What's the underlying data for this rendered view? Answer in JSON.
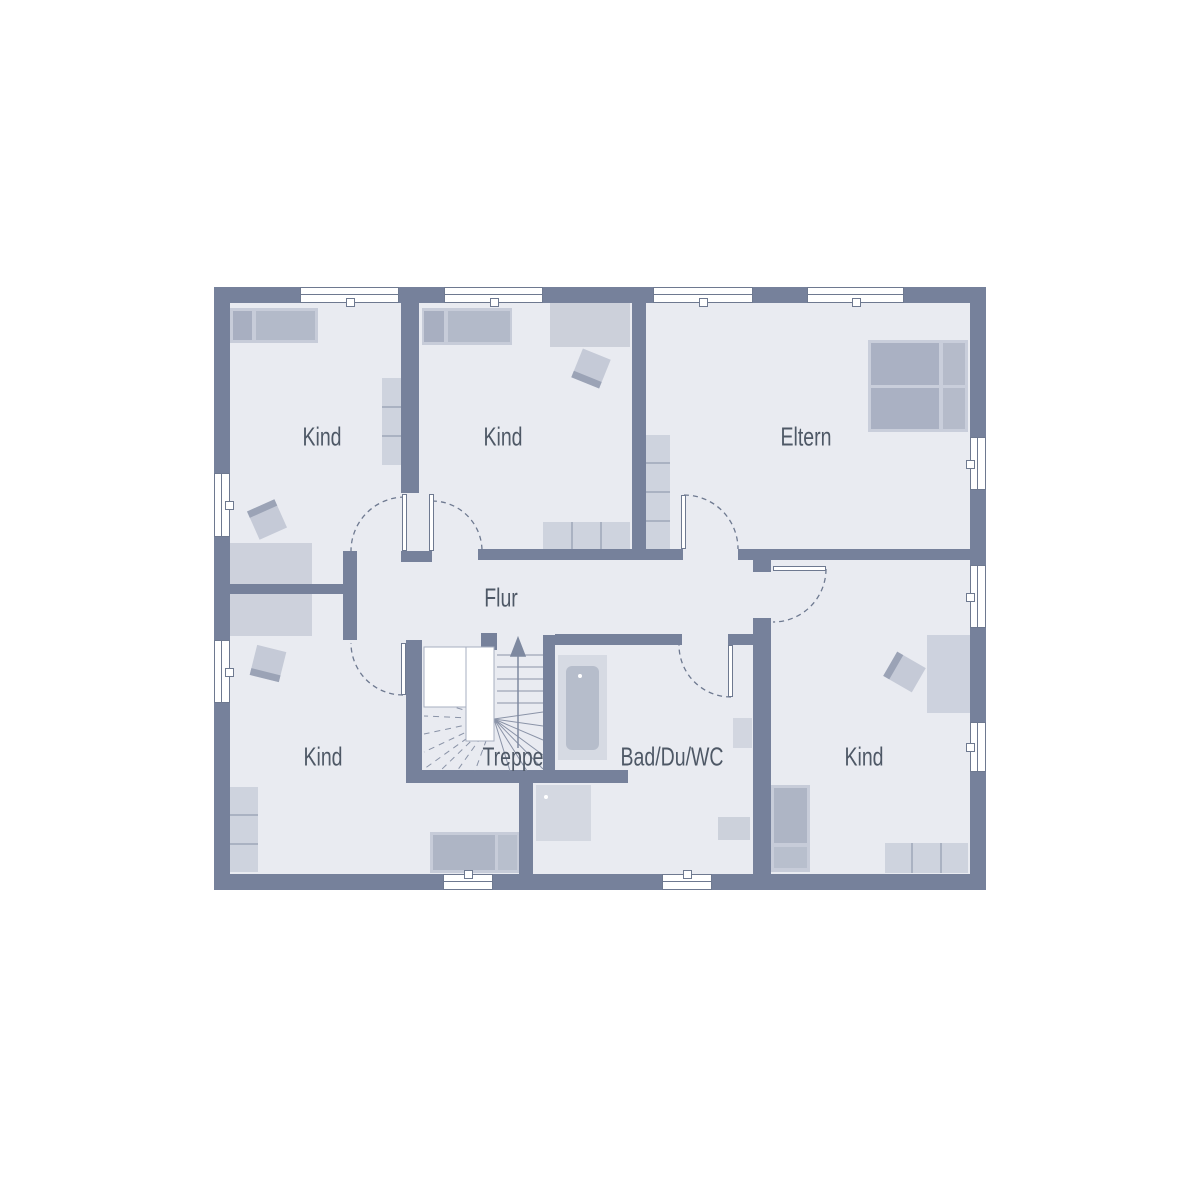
{
  "floorplan": {
    "rooms": [
      {
        "id": "kind-top-left",
        "label": "Kind"
      },
      {
        "id": "kind-top-middle",
        "label": "Kind"
      },
      {
        "id": "eltern",
        "label": "Eltern"
      },
      {
        "id": "flur",
        "label": "Flur"
      },
      {
        "id": "kind-bottom-left",
        "label": "Kind"
      },
      {
        "id": "treppe",
        "label": "Treppe"
      },
      {
        "id": "bad-du-wc",
        "label": "Bad/Du/WC"
      },
      {
        "id": "kind-bottom-right",
        "label": "Kind"
      }
    ],
    "colors": {
      "outside": "#ffffff",
      "floor_fill": "#e9ebf1",
      "wall": "#76819b",
      "furniture_light": "#ced3de",
      "furniture_medium": "#b3bac9",
      "furniture_dark": "#a8afc1",
      "stair_lines": "#8a93a7",
      "text": "#4e5866"
    }
  }
}
